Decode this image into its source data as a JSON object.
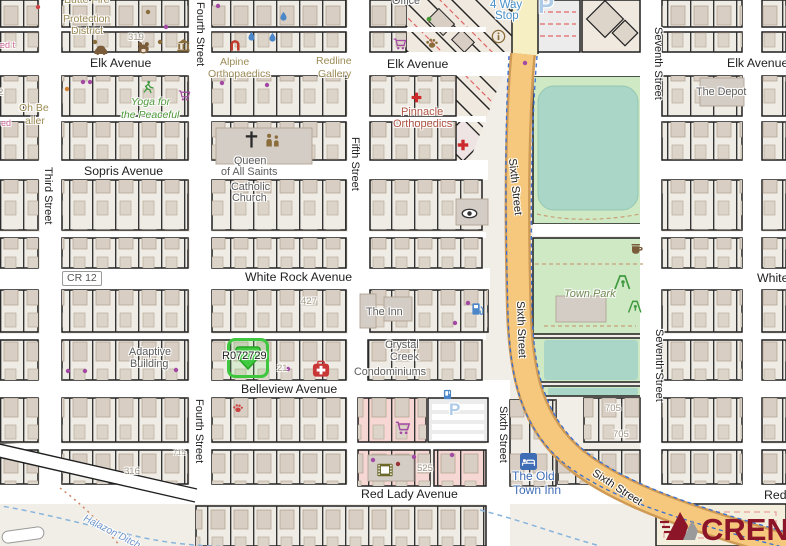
{
  "parcel_marker": {
    "id": "R072729"
  },
  "logo": {
    "text": "CREN"
  },
  "colors": {
    "marker_green": "#3ec63e",
    "highway_orange": "#f5c87e",
    "park_green": "#cfe9c5",
    "water_teal": "#a9d6c6",
    "logo_maroon": "#8c1528",
    "retail_pink": "#f6d7d3"
  },
  "labels": [
    {
      "id": "elk-avenue-left",
      "text": "Elk Avenue"
    },
    {
      "id": "elk-avenue-center",
      "text": "Elk Avenue"
    },
    {
      "id": "elk-avenue-right",
      "text": "Elk Avenue"
    },
    {
      "id": "sopris-avenue",
      "text": "Sopris Avenue"
    },
    {
      "id": "white-rock-avenue",
      "text": "White Rock Avenue"
    },
    {
      "id": "white-rock-avenue-east",
      "text": "White Rock Avenue"
    },
    {
      "id": "belleview-avenue",
      "text": "Belleview Avenue"
    },
    {
      "id": "red-lady-avenue",
      "text": "Red Lady Avenue"
    },
    {
      "id": "red-lady-avenue-east",
      "text": "Red Lady Avenue"
    },
    {
      "id": "third-street",
      "text": "Third Street"
    },
    {
      "id": "fourth-street-north",
      "text": "Fourth Street"
    },
    {
      "id": "fourth-street-south",
      "text": "Fourth Street"
    },
    {
      "id": "fifth-street",
      "text": "Fifth Street"
    },
    {
      "id": "sixth-street-south",
      "text": "Sixth Street"
    },
    {
      "id": "seventh-street-north",
      "text": "Seventh Street"
    },
    {
      "id": "seventh-street-east",
      "text": "Seventh Street"
    },
    {
      "id": "sixth-street-hwy-n",
      "text": "Sixth Street"
    },
    {
      "id": "sixth-street-hwy-m",
      "text": "Sixth Street"
    },
    {
      "id": "sixth-street-hwy-s",
      "text": "Sixth Street"
    },
    {
      "id": "cr-12",
      "text": "CR 12"
    },
    {
      "id": "halazon-ditch",
      "text": "Halazon Ditch"
    },
    {
      "id": "butte-fire",
      "text": "Butte Fire"
    },
    {
      "id": "protection-district-1",
      "text": "Protection"
    },
    {
      "id": "protection-district-2",
      "text": "District"
    },
    {
      "id": "office-frag",
      "text": "Office"
    },
    {
      "id": "num-319",
      "text": "319"
    },
    {
      "id": "num-2",
      "text": "2"
    },
    {
      "id": "alpine-1",
      "text": "Alpine"
    },
    {
      "id": "alpine-2",
      "text": "Orthopaedics"
    },
    {
      "id": "redline-1",
      "text": "Redline"
    },
    {
      "id": "redline-2",
      "text": "Gallery"
    },
    {
      "id": "oh-be",
      "text": "Oh Be"
    },
    {
      "id": "gallery-frag",
      "text": "aller"
    },
    {
      "id": "pink-frag-1",
      "text": "ed t"
    },
    {
      "id": "pink-frag-2",
      "text": "ed"
    },
    {
      "id": "yoga-1",
      "text": "Yoga for"
    },
    {
      "id": "yoga-2",
      "text": "the Peaceful"
    },
    {
      "id": "queen-1",
      "text": "Queen"
    },
    {
      "id": "queen-2",
      "text": "of All Saints"
    },
    {
      "id": "queen-3",
      "text": "Catholic"
    },
    {
      "id": "queen-4",
      "text": "Church"
    },
    {
      "id": "four-way-1",
      "text": "4 Way"
    },
    {
      "id": "four-way-2",
      "text": "Stop"
    },
    {
      "id": "parking-p-north",
      "text": "P"
    },
    {
      "id": "parking-p-south",
      "text": "P"
    },
    {
      "id": "pinnacle-1",
      "text": "Pinnacle"
    },
    {
      "id": "pinnacle-2",
      "text": "Orthopedics"
    },
    {
      "id": "the-depot",
      "text": "The Depot"
    },
    {
      "id": "town-park",
      "text": "Town Park"
    },
    {
      "id": "the-inn",
      "text": "The Inn"
    },
    {
      "id": "crystal-1",
      "text": "Crystal"
    },
    {
      "id": "crystal-2",
      "text": "Creek"
    },
    {
      "id": "crystal-3",
      "text": "Condominiums"
    },
    {
      "id": "adaptive-1",
      "text": "Adaptive"
    },
    {
      "id": "adaptive-2",
      "text": "Building"
    },
    {
      "id": "the-old-1",
      "text": "The Old"
    },
    {
      "id": "the-old-2",
      "text": "Town Inn"
    },
    {
      "id": "num-427",
      "text": "427"
    },
    {
      "id": "num-21",
      "text": "21"
    },
    {
      "id": "num-525",
      "text": "525"
    },
    {
      "id": "num-705-a",
      "text": "705"
    },
    {
      "id": "num-705-b",
      "text": "705"
    },
    {
      "id": "num-316",
      "text": "316"
    },
    {
      "id": "num-715",
      "text": "715"
    }
  ],
  "icons": [
    {
      "id": "car",
      "name": "car-icon"
    },
    {
      "id": "bear",
      "name": "bear-icon"
    },
    {
      "id": "museum",
      "name": "museum-icon"
    },
    {
      "id": "arch",
      "name": "artwork-arch-icon"
    },
    {
      "id": "drop1",
      "name": "water-drop-icon"
    },
    {
      "id": "drop2",
      "name": "water-drop-icon"
    },
    {
      "id": "drop3",
      "name": "water-drop-icon"
    },
    {
      "id": "paw-brown",
      "name": "paw-icon"
    },
    {
      "id": "cart-elk",
      "name": "shopping-cart-icon"
    },
    {
      "id": "cart-yoga",
      "name": "shopping-cart-icon"
    },
    {
      "id": "cart-south",
      "name": "shopping-cart-icon"
    },
    {
      "id": "runner",
      "name": "running-person-icon"
    },
    {
      "id": "tree",
      "name": "tree-icon"
    },
    {
      "id": "info",
      "name": "info-icon"
    },
    {
      "id": "church-cross",
      "name": "church-cross-icon"
    },
    {
      "id": "childcare",
      "name": "childcare-icon"
    },
    {
      "id": "pharmacy",
      "name": "medical-cross-icon"
    },
    {
      "id": "clinic",
      "name": "medical-cross-icon"
    },
    {
      "id": "first-aid",
      "name": "first-aid-icon"
    },
    {
      "id": "eye",
      "name": "optician-eye-icon"
    },
    {
      "id": "fuel",
      "name": "fuel-pump-icon"
    },
    {
      "id": "bed",
      "name": "hotel-bed-icon"
    },
    {
      "id": "cinema",
      "name": "film-icon"
    },
    {
      "id": "coffee",
      "name": "coffee-cup-icon"
    },
    {
      "id": "pg1",
      "name": "playground-icon"
    },
    {
      "id": "pg2",
      "name": "playground-icon"
    },
    {
      "id": "vending",
      "name": "vending-machine-icon"
    },
    {
      "id": "paw-red",
      "name": "paw-icon"
    }
  ]
}
